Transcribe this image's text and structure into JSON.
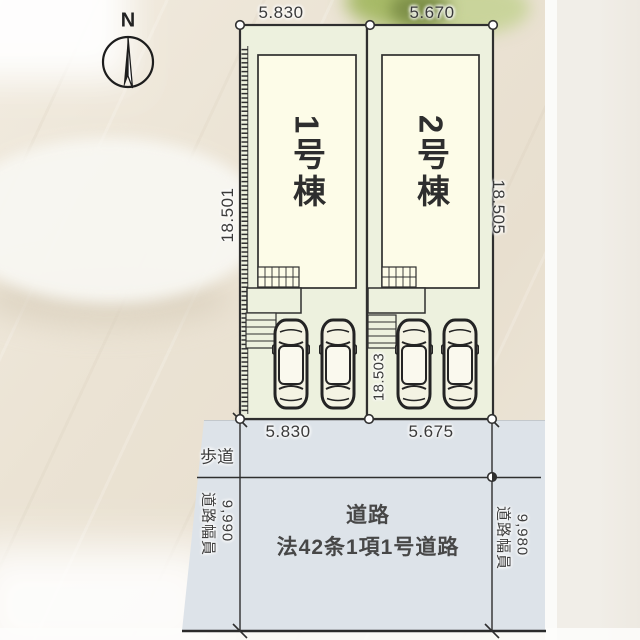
{
  "compass": {
    "north_label": "N"
  },
  "site_plan": {
    "lots": [
      {
        "id": "1",
        "unit_label": "1号棟",
        "width_top": "5.830",
        "width_bottom": "5.830",
        "depth_label": "18.501"
      },
      {
        "id": "2",
        "unit_label": "2号棟",
        "width_top": "5.670",
        "width_bottom": "5.675",
        "depth_label": "18.505"
      }
    ],
    "center_depth_label": "18.503"
  },
  "sidewalk": {
    "label": "歩道"
  },
  "road": {
    "title": "道路",
    "subtitle": "法42条1項1号道路",
    "left_width": {
      "label": "道路幅員",
      "value": "9,990"
    },
    "right_width": {
      "label": "道路幅員",
      "value": "9,980"
    }
  },
  "colors": {
    "lot_fill": "#edf1de",
    "building_fill": "#fdfce8",
    "road_fill": "#dde3e9",
    "line": "#2f2f2f"
  }
}
